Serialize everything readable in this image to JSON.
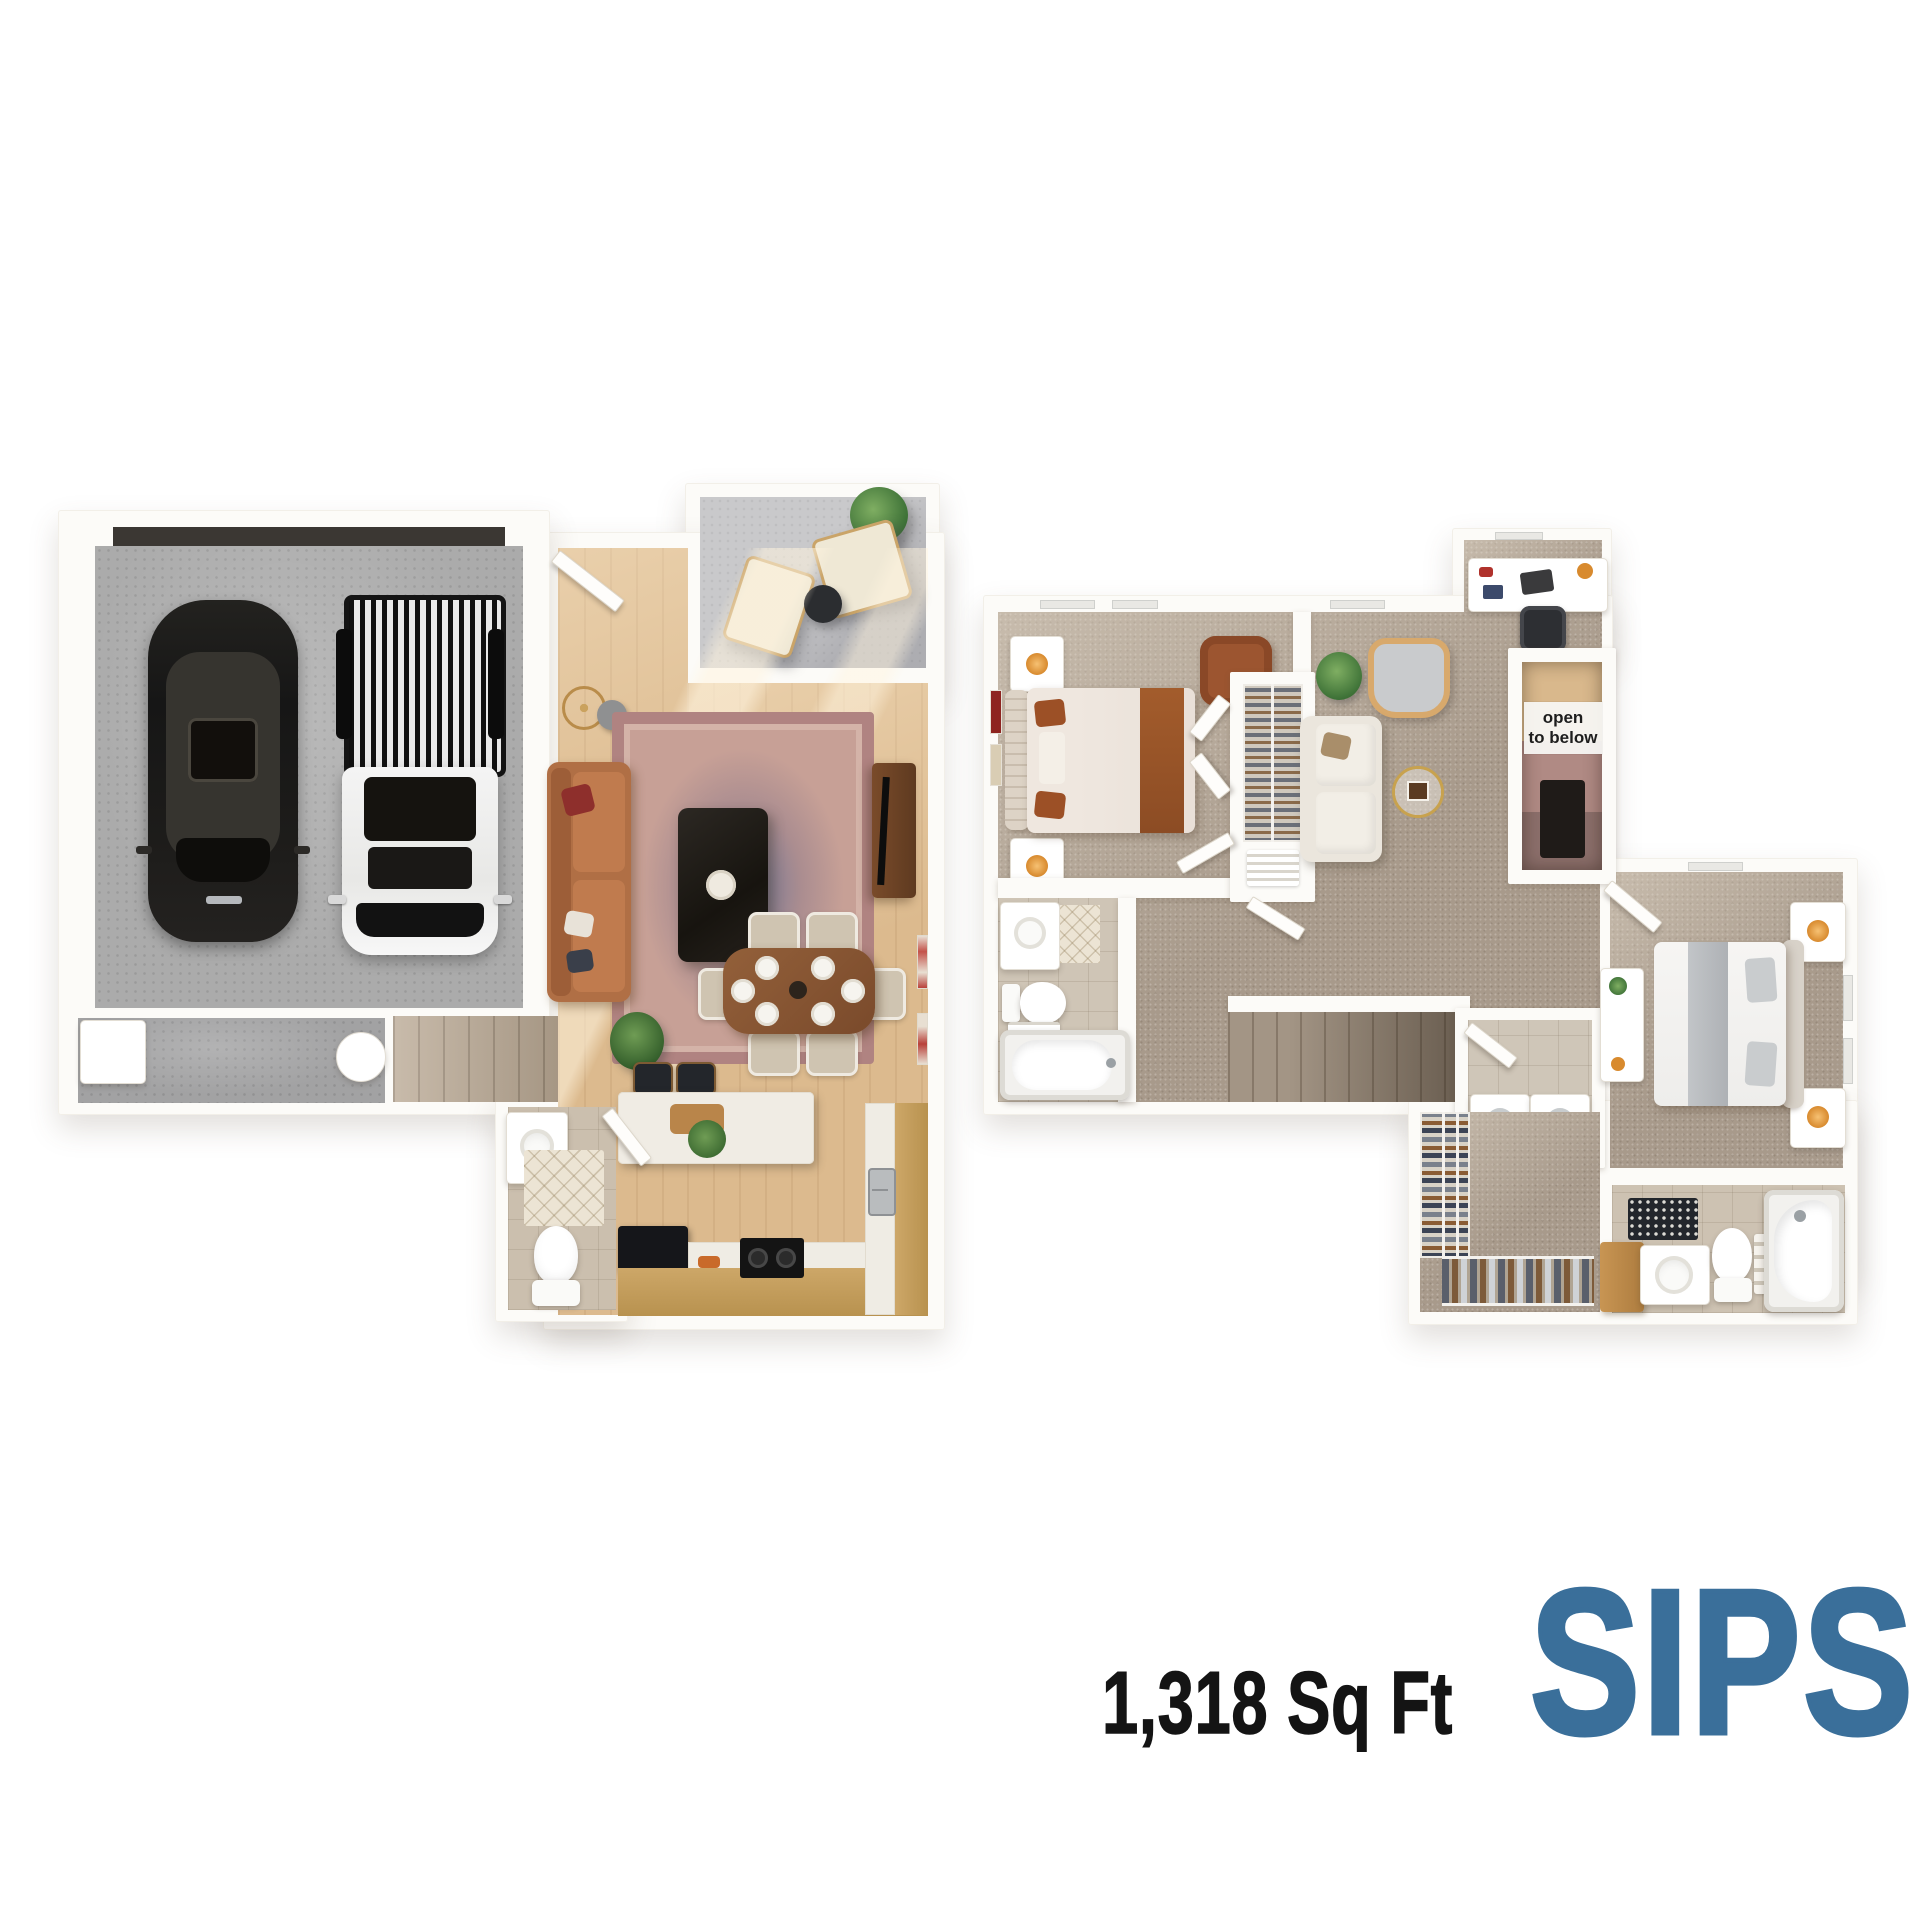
{
  "title": {
    "area": "1,318 Sq Ft",
    "plan_name": "SIPS",
    "plan_name_style": "color:#3a6f9a"
  },
  "annotations": {
    "open_line1": "open",
    "open_line2": "to below"
  },
  "colors": {
    "plan_name_blue": "#3a6f9a",
    "area_text": "#141414",
    "open_label_bg": "#f5f4f2",
    "open_label_text": "#1e1e1e",
    "wall_white": "#fcfbf8",
    "wood_floor": "#dcba8e",
    "carpet": "#a89a8b",
    "garage_concrete": "#ababab",
    "patio_concrete": "#c9c9cb",
    "tile": "#cdc2b2",
    "cabinet_wood": "#c29d5f",
    "leather_sofa": "#b06f45",
    "dining_table_wood": "#8a5532",
    "black_car": "#1a1a1a",
    "white_truck": "#f2f2f2",
    "page_background": "#ffffff"
  }
}
